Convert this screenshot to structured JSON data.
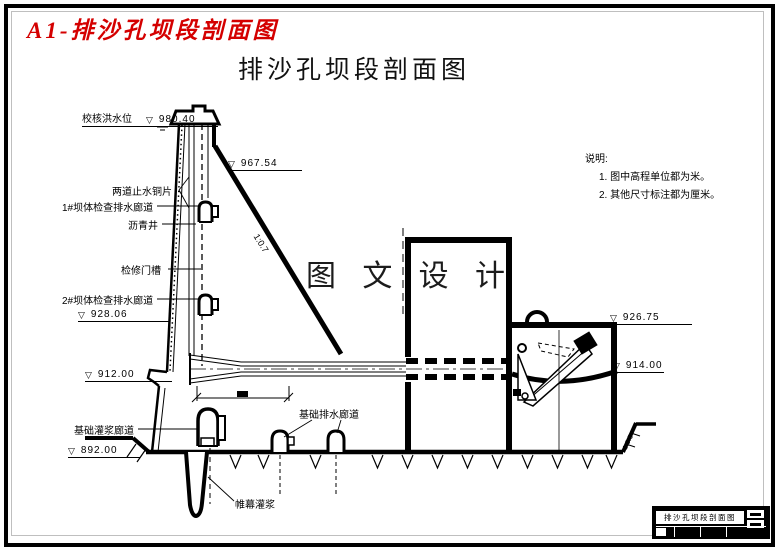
{
  "header": {
    "doc_label": "A1-排沙孔坝段剖面图",
    "title": "排沙孔坝段剖面图"
  },
  "watermark": "图 文 设 计",
  "marker_glyph": "▽",
  "elevations": {
    "check_flood_label": "校核洪水位",
    "e980": "980.40",
    "e967": "967.54",
    "e928": "928.06",
    "e912": "912.00",
    "e892": "892.00",
    "e926": "926.75",
    "e914": "914.00"
  },
  "labels": {
    "copper_seals": "两道止水铜片",
    "gallery1": "1#坝体检查排水廊道",
    "asphalt_well": "沥青井",
    "gate_slot": "检修门槽",
    "gallery2": "2#坝体检查排水廊道",
    "foundation_grout": "基础灌浆廊道",
    "foundation_drain": "基础排水廊道",
    "curtain_grout": "帷幕灌浆",
    "slope_left": "1:0.7",
    "slope_right": "1:0.5"
  },
  "notes": {
    "heading": "说明:",
    "item1": "1. 图中高程单位都为米。",
    "item2": "2. 其他尺寸标注都为厘米。"
  },
  "title_block": {
    "title": "排沙孔坝段剖面图"
  },
  "colors": {
    "accent_red": "#d40000",
    "ink": "#000000",
    "paper": "#ffffff"
  }
}
